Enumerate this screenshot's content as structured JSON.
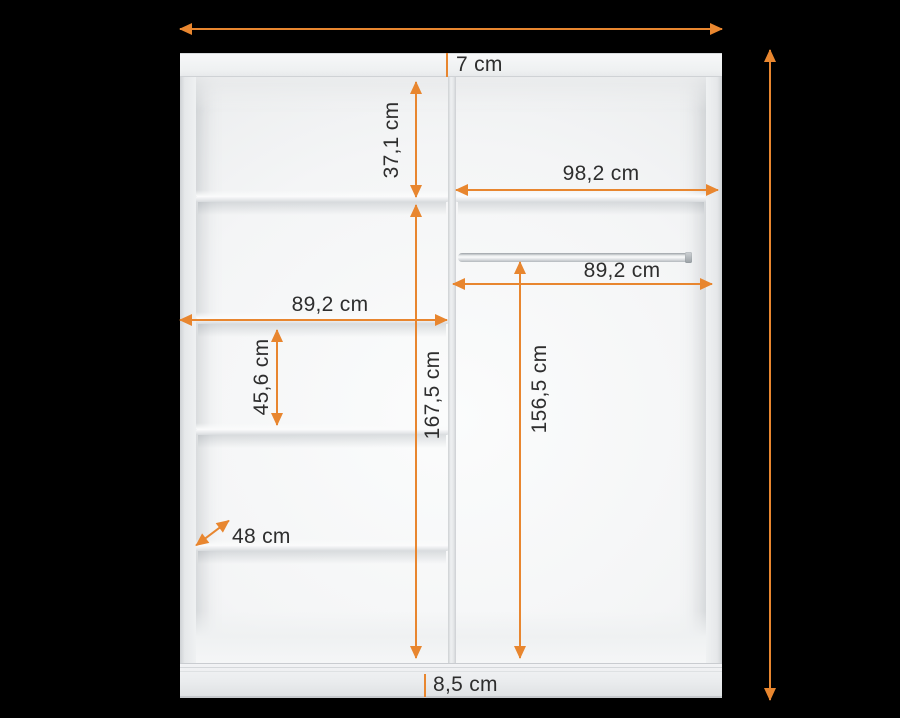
{
  "diagram": {
    "title": "wardrobe interior dimensions",
    "unit": "cm",
    "accent_color": "#e8862f",
    "text_color": "#2e2e2e",
    "background_color": "#000000",
    "structure": {
      "left_section_shelves": 4,
      "right_section_shelves": 1,
      "hanging_rods": 1
    },
    "dimensions": {
      "top_panel_thickness": {
        "label": "7 cm",
        "value": 7
      },
      "upper_shelf_gap": {
        "label": "37,1 cm",
        "value": 37.1
      },
      "right_section_width": {
        "label": "98,2 cm",
        "value": 98.2
      },
      "hanging_rod_width": {
        "label": "89,2 cm",
        "value": 89.2
      },
      "left_shelf_width": {
        "label": "89,2 cm",
        "value": 89.2
      },
      "left_section_height": {
        "label": "167,5 cm",
        "value": 167.5
      },
      "hanging_space_height": {
        "label": "156,5 cm",
        "value": 156.5
      },
      "middle_shelf_gap": {
        "label": "45,6 cm",
        "value": 45.6
      },
      "depth": {
        "label": "48 cm",
        "value": 48
      },
      "plinth_height": {
        "label": "8,5 cm",
        "value": 8.5
      }
    }
  }
}
